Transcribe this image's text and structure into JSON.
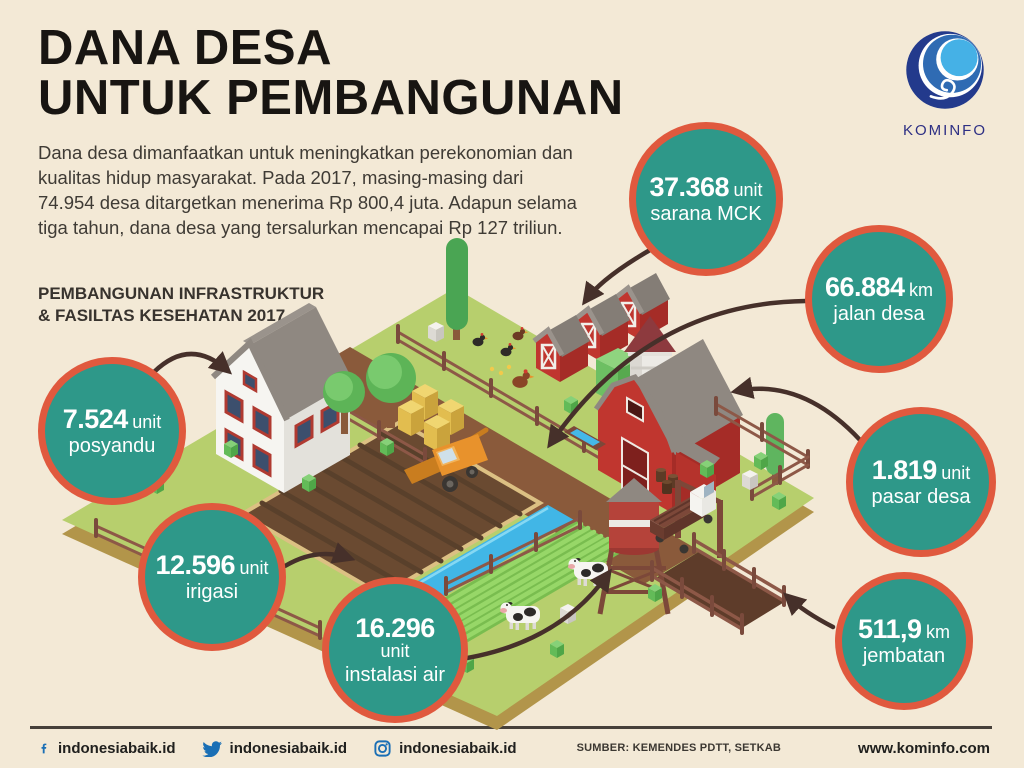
{
  "colors": {
    "bg": "#f3e9d6",
    "ink": "#181512",
    "body": "#3f3b35",
    "teal": "#2e9889",
    "ring": "#e0593e",
    "arrow": "#46302a",
    "blue": "#1a6fb5",
    "navy": "#2d2f84",
    "rule": "#46403a"
  },
  "header": {
    "title_line1": "DANA DESA",
    "title_line2": "UNTUK PEMBANGUNAN",
    "intro": "Dana desa dimanfaatkan untuk meningkatkan perekonomian dan kualitas hidup masyarakat. Pada 2017, masing-masing dari 74.954 desa ditargetkan menerima Rp 800,4 juta. Adapun selama tiga tahun, dana desa yang tersalurkan mencapai Rp 127 triliun.",
    "subtitle_line1": "PEMBANGUNAN INFRASTRUKTUR",
    "subtitle_line2": "& FASILTAS KESEHATAN 2017"
  },
  "logo": {
    "name": "KOMINFO"
  },
  "stats": [
    {
      "value": "37.368",
      "unit": "unit",
      "label": "sarana MCK"
    },
    {
      "value": "66.884",
      "unit": "km",
      "label": "jalan desa"
    },
    {
      "value": "7.524",
      "unit": "unit",
      "label": "posyandu"
    },
    {
      "value": "1.819",
      "unit": "unit",
      "label": "pasar desa"
    },
    {
      "value": "12.596",
      "unit": "unit",
      "label": "irigasi"
    },
    {
      "value": "16.296",
      "unit": "unit",
      "label": "instalasi air"
    },
    {
      "value": "511,9",
      "unit": "km",
      "label": "jembatan"
    }
  ],
  "footer": {
    "social": [
      {
        "icon": "facebook-icon",
        "handle": "indonesiabaik.id"
      },
      {
        "icon": "twitter-icon",
        "handle": "indonesiabaik.id"
      },
      {
        "icon": "instagram-icon",
        "handle": "indonesiabaik.id"
      }
    ],
    "source": "SUMBER: KEMENDES PDTT, SETKAB",
    "website": "www.kominfo.com"
  }
}
